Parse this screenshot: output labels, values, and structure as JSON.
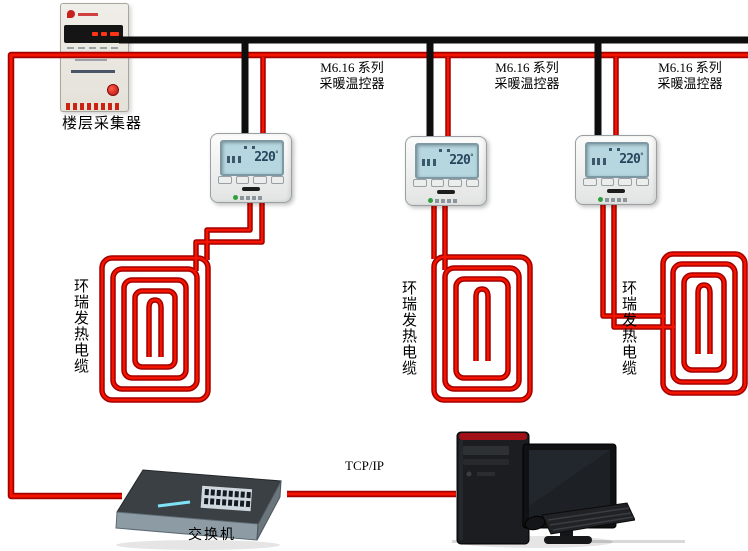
{
  "diagram": {
    "collector": {
      "label": "楼层采集器"
    },
    "thermostat_label": {
      "line1": "M6.16 系列",
      "line2": "采暖温控器"
    },
    "thermostats": [
      {
        "display": "220"
      },
      {
        "display": "220"
      },
      {
        "display": "220"
      }
    ],
    "degree": "°",
    "cable_label": "环瑞发热电缆",
    "switch_label": "交换机",
    "network_label": "TCP/IP",
    "colors": {
      "wire_red": "#f51400",
      "wire_red_edge": "#a30000",
      "wire_black": "#0e0e0e",
      "lcd_bg": "#b6d7e0",
      "led_strip": "#7fe3f7",
      "button_red": "#b80f0f"
    }
  }
}
